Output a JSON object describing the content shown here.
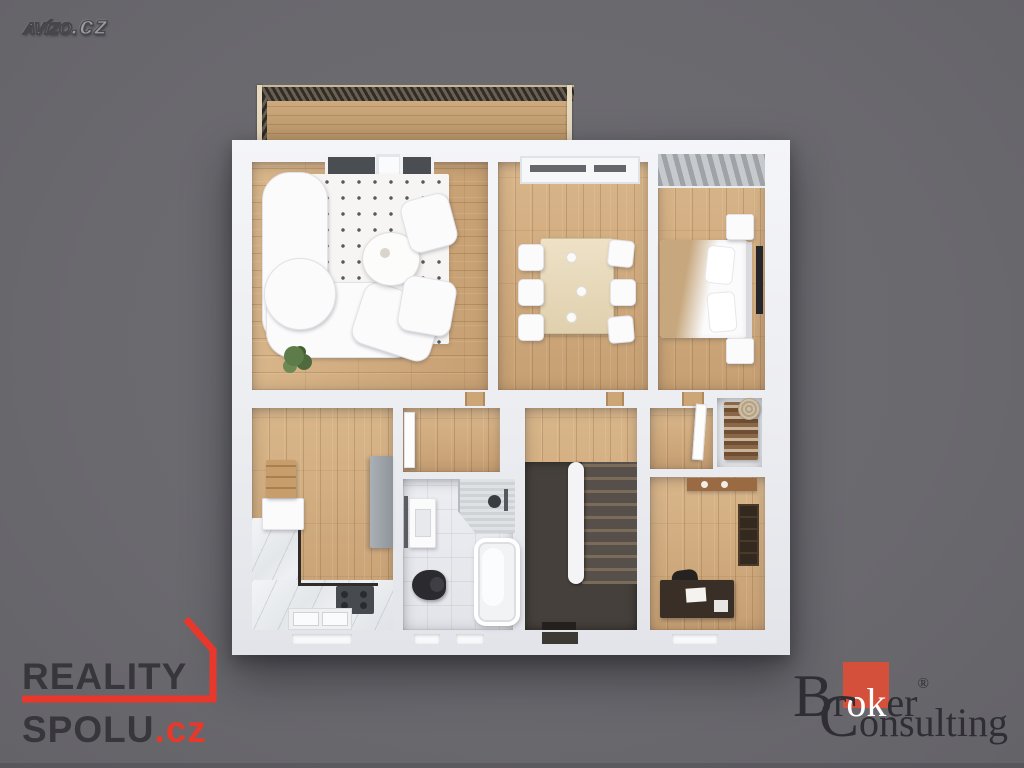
{
  "background_color": "#6a696e",
  "watermark": {
    "brand": "AVÍZO",
    "tld": ".cz"
  },
  "reality_spolu": {
    "line1": "REALITY",
    "line2": "SPOLU",
    "tld": ".cz",
    "accent_color": "#e8382c",
    "text_color": "#37363b"
  },
  "broker_consulting": {
    "prefix": "Br",
    "highlight": "ok",
    "suffix": "er",
    "registered": "®",
    "line2": "Consulting",
    "accent_color": "#d5503b",
    "text_color": "#2f2e34"
  },
  "floor_plan": {
    "type": "3d-top-down-render",
    "rooms": [
      "balcony",
      "living-room",
      "dining-room",
      "bedroom",
      "kitchen",
      "hallway",
      "bathroom",
      "staircase",
      "closet",
      "office"
    ],
    "wood_floor_color": "#d0aa7c",
    "wall_color": "#eef0f4"
  }
}
